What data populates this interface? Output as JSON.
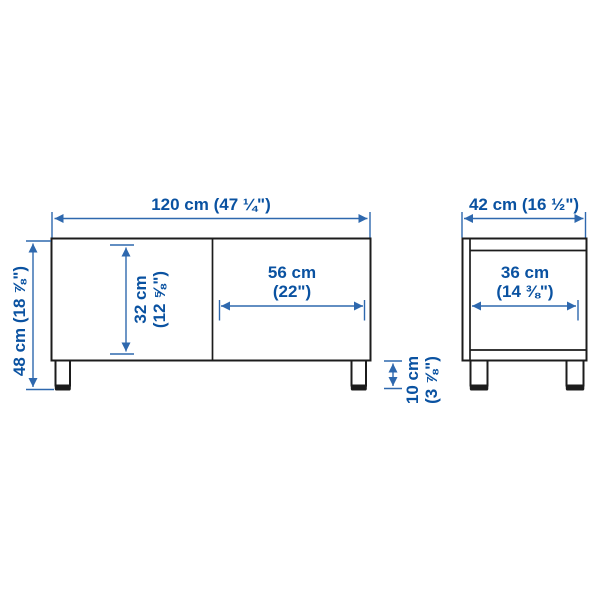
{
  "colors": {
    "dimension_text": "#0a52a1",
    "dimension_line": "#2e68ae",
    "outline": "#1c1c1c",
    "surface": "#ffffff"
  },
  "front_view": {
    "overall_width_label": "120 cm (47 ¼\")",
    "overall_height_label": "48 cm (18 ⅞\")",
    "inner_height_cm": "32 cm",
    "inner_height_in": "(12 ⅝\")",
    "door_width_cm": "56 cm",
    "door_width_in": "(22\")",
    "leg_height_cm": "10 cm",
    "leg_height_in": "(3 ⅞\")"
  },
  "side_view": {
    "overall_depth_label": "42 cm (16 ½\")",
    "inner_depth_cm": "36 cm",
    "inner_depth_in": "(14 ⅜\")"
  }
}
